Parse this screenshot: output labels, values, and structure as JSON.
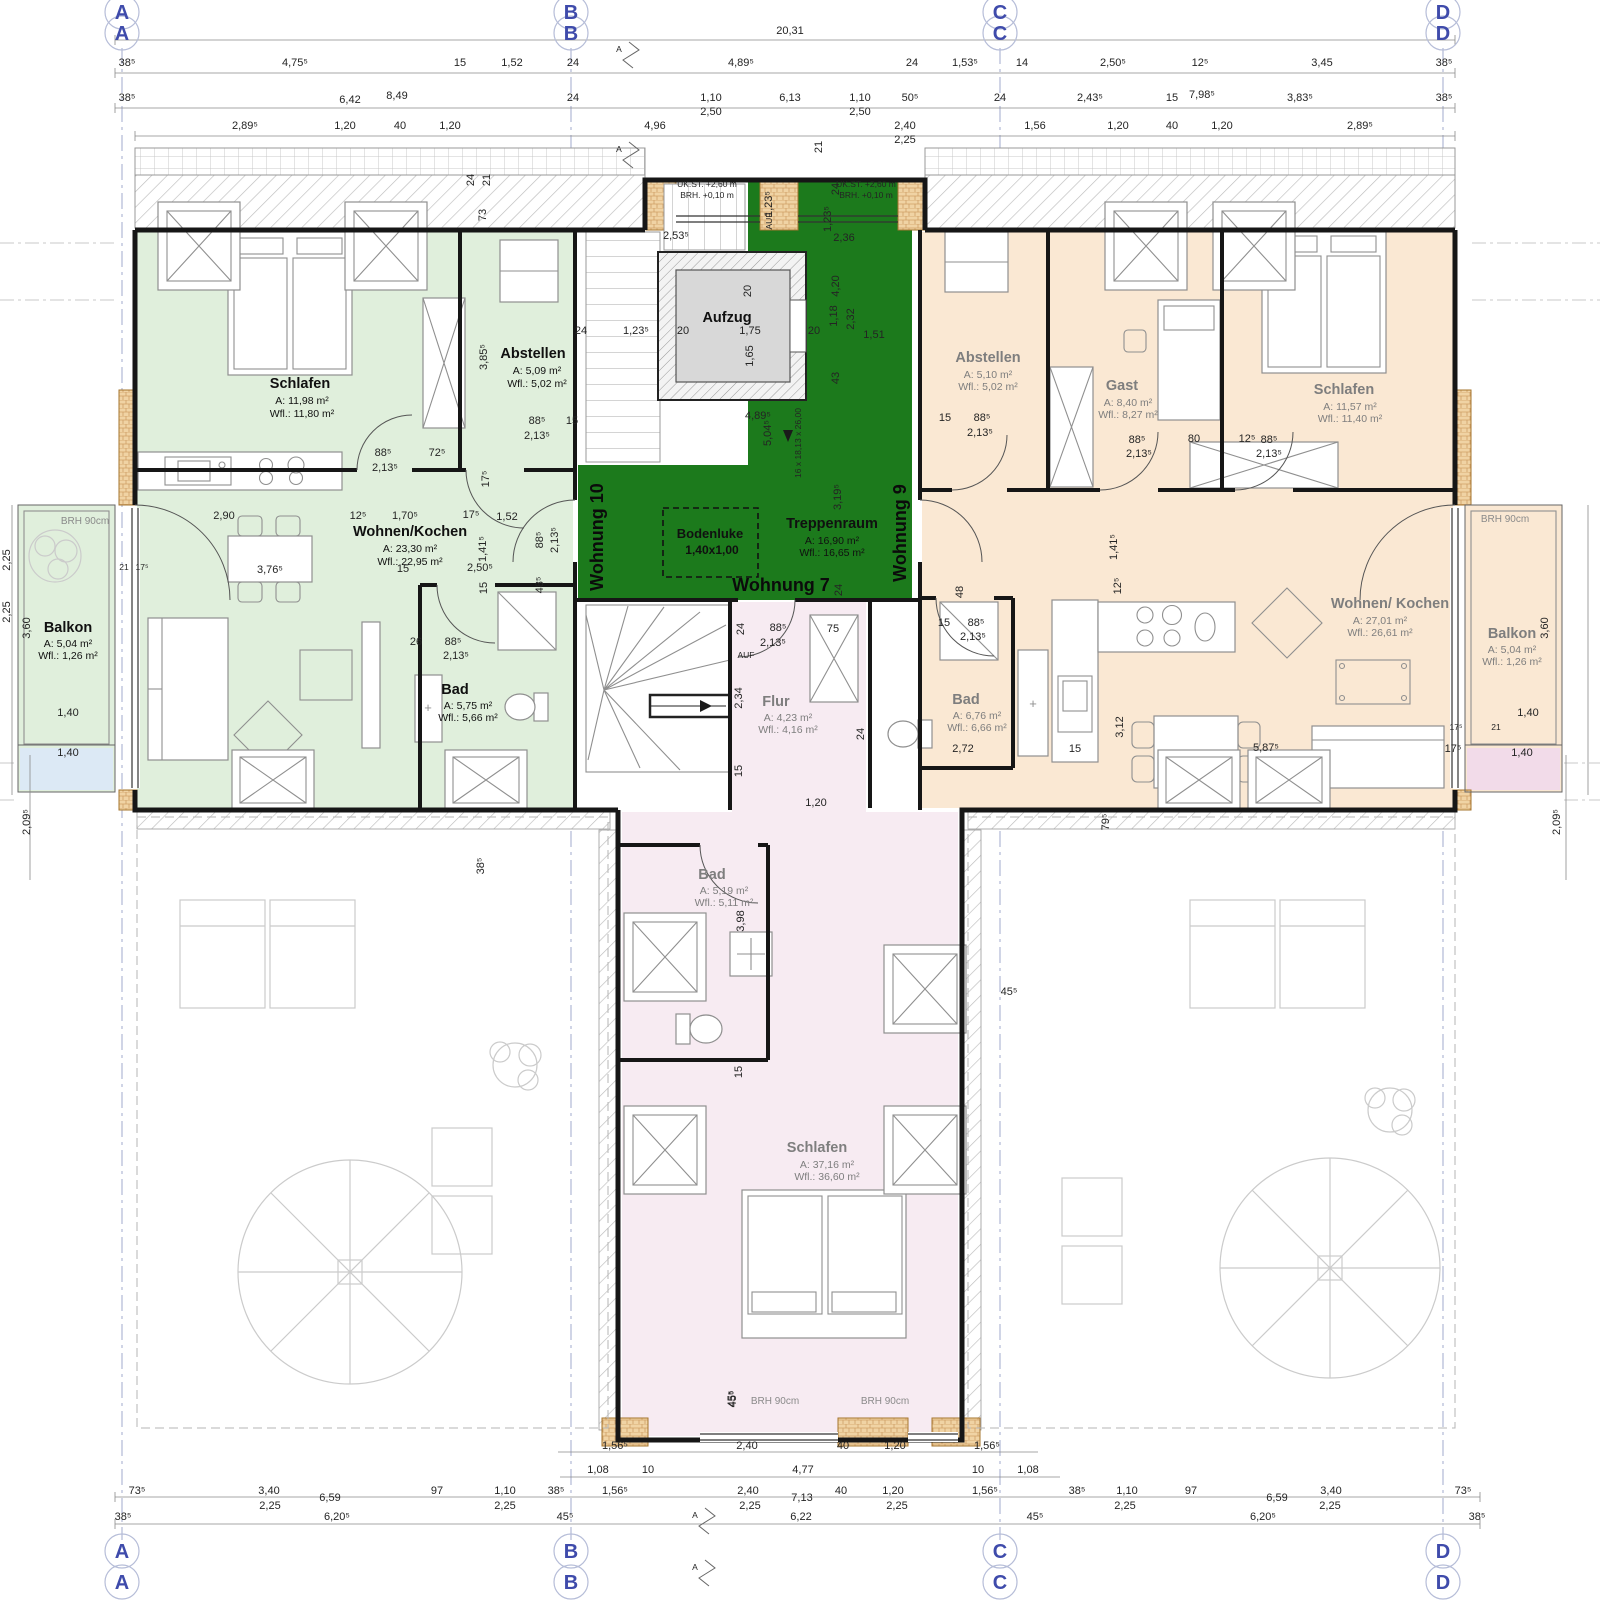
{
  "grid": {
    "a": "A",
    "b": "B",
    "c": "C",
    "d": "D"
  },
  "apartments": {
    "w7": "Wohnung 7",
    "w9": "Wohnung 9",
    "w10": "Wohnung 10"
  },
  "rooms": {
    "left_schlafen": {
      "name": "Schlafen",
      "area": "A:    11,98 m²",
      "wfl": "Wfl.: 11,80 m²"
    },
    "left_abstellen": {
      "name": "Abstellen",
      "area": "A:    5,09 m²",
      "wfl": "Wfl.: 5,02 m²"
    },
    "left_wohnen": {
      "name": "Wohnen/Kochen",
      "area": "A:    23,30 m²",
      "wfl": "Wfl.: 22,95 m²"
    },
    "left_bad": {
      "name": "Bad",
      "area": "A:    5,75 m²",
      "wfl": "Wfl.: 5,66 m²"
    },
    "left_balkon": {
      "name": "Balkon",
      "area": "A:    5,04 m²",
      "wfl": "Wfl.: 1,26 m²",
      "brh": "BRH 90cm"
    },
    "treppenraum": {
      "name": "Treppenraum",
      "area": "A:    16,90 m²",
      "wfl": "Wfl.: 16,65 m²"
    },
    "aufzug": {
      "name": "Aufzug"
    },
    "bodenluke": {
      "name": "Bodenluke",
      "size": "1,40x1,00"
    },
    "right_abstellen": {
      "name": "Abstellen",
      "area": "A:    5,10 m²",
      "wfl": "Wfl.: 5,02 m²"
    },
    "right_gast": {
      "name": "Gast",
      "area": "A:    8,40 m²",
      "wfl": "Wfl.: 8,27 m²"
    },
    "right_schlafen": {
      "name": "Schlafen",
      "area": "A:    11,57 m²",
      "wfl": "Wfl.: 11,40 m²"
    },
    "right_wohnen": {
      "name": "Wohnen/ Kochen",
      "area": "A:    27,01 m²",
      "wfl": "Wfl.: 26,61 m²"
    },
    "right_bad": {
      "name": "Bad",
      "area": "A:    6,76 m²",
      "wfl": "Wfl.: 6,66 m²"
    },
    "right_balkon": {
      "name": "Balkon",
      "area": "A:    5,04 m²",
      "wfl": "Wfl.: 1,26 m²",
      "brh": "BRH 90cm"
    },
    "flur": {
      "name": "Flur",
      "area": "A:    4,23 m²",
      "wfl": "Wfl.: 4,16 m²"
    },
    "bottom_bad": {
      "name": "Bad",
      "area": "A:    5,19 m²",
      "wfl": "Wfl.: 5,11 m²"
    },
    "bottom_schlafen": {
      "name": "Schlafen",
      "area": "A:    37,16 m²",
      "wfl": "Wfl.: 36,60 m²"
    },
    "brh_window_left": "BRH 90cm",
    "brh_window_right": "BRH 90cm"
  },
  "annotations": {
    "ukst": "UK.ST. +2,60 m",
    "brh": "BRH. +0,10 m",
    "stair_steps": "16 x 18,13 x 26,00",
    "auf": "AUF",
    "section": "A"
  },
  "colors": {
    "left_tint": "#e0efdc",
    "right_tint": "#fae8d3",
    "center_green": "#1c7a1c",
    "bottom_tint": "#f7ebf2",
    "grid_blue": "#3f4bab",
    "cab_gray": "#d8d8d8",
    "brick": "#f0d3a4",
    "pale_blue": "#dce9f5",
    "pale_pink": "#f2dbe9"
  },
  "dims": {
    "total": "20,31",
    "t1": [
      "38⁵",
      "4,75⁵",
      "15",
      "1,52",
      "24",
      "4,89⁵",
      "24",
      "1,53⁵",
      "14",
      "2,50⁵",
      "12⁵",
      "3,45",
      "38⁵"
    ],
    "t2": [
      "38⁵",
      "6,42",
      "8,49",
      "24",
      "1,10",
      "2,50",
      "6,13",
      "1,10",
      "2,50",
      "50⁵",
      "24",
      "2,43⁵",
      "15",
      "7,98⁵",
      "3,83⁵",
      "38⁵"
    ],
    "t3": [
      "2,89⁵",
      "1,20",
      "40",
      "1,20",
      "4,96",
      "2,40",
      "2,25",
      "1,56",
      "1,20",
      "40",
      "1,20",
      "2,89⁵",
      "21",
      "24",
      "21",
      "73"
    ],
    "b1": [
      "1,56⁵",
      "2,40",
      "40",
      "1,20",
      "1,56⁵",
      "45⁵"
    ],
    "b2": [
      "1,08",
      "10",
      "4,77",
      "10",
      "1,08"
    ],
    "b3l": [
      "73⁵",
      "3,40",
      "6,59",
      "97",
      "1,10",
      "38⁵",
      "2,25",
      "2,25"
    ],
    "b3c": [
      "1,56⁵",
      "2,40",
      "7,13",
      "40",
      "1,20",
      "1,56⁵",
      "2,25",
      "2,25"
    ],
    "b3r": [
      "38⁵",
      "1,10",
      "97",
      "6,59",
      "3,40",
      "73⁵",
      "2,25",
      "2,25"
    ],
    "b4": [
      "38⁵",
      "6,20⁵",
      "45⁵",
      "6,22",
      "45⁵",
      "6,20⁵",
      "38⁵"
    ],
    "lv": [
      "2,25",
      "2,25",
      "3,60",
      "1,40",
      "1,40",
      "2,09⁵",
      "21",
      "17⁵"
    ],
    "rv": [
      "3,60",
      "1,40",
      "1,40",
      "2,09⁵",
      "21",
      "17⁵"
    ],
    "li": [
      "88⁵",
      "2,13⁵",
      "72⁵",
      "2,90",
      "12⁵",
      "1,70⁵",
      "17⁵",
      "1,52",
      "3,76⁵",
      "15",
      "2,50⁵",
      "1,41⁵",
      "88⁵",
      "2,13⁵",
      "48⁵",
      "15",
      "26",
      "88⁵",
      "2,13⁵",
      "3,85⁵",
      "24",
      "88⁵",
      "2,13⁵",
      "15",
      "17⁵",
      "38⁵"
    ],
    "ci": [
      "2,53⁵",
      "1,23⁵",
      "20",
      "1,75",
      "20",
      "1,65",
      "24",
      "1,23⁵",
      "1,23⁵",
      "2,36",
      "20",
      "4,20",
      "1,18",
      "2,32",
      "1,51",
      "43",
      "4,89⁵",
      "5,04⁵",
      "3,19⁵",
      "24",
      "24",
      "88⁵",
      "2,13⁵",
      "75",
      "2,34",
      "15",
      "1,20",
      "24",
      "45⁵",
      "3,98",
      "15"
    ],
    "ri": [
      "15",
      "88⁵",
      "2,13⁵",
      "88⁵",
      "2,13⁵",
      "80",
      "12⁵",
      "88⁵",
      "2,13⁵",
      "48",
      "15",
      "88⁵",
      "2,13⁵",
      "12⁵",
      "2,72",
      "15",
      "3,12",
      "5,87⁵",
      "17⁵",
      "1,41⁵",
      "79⁵",
      "45⁵"
    ]
  }
}
